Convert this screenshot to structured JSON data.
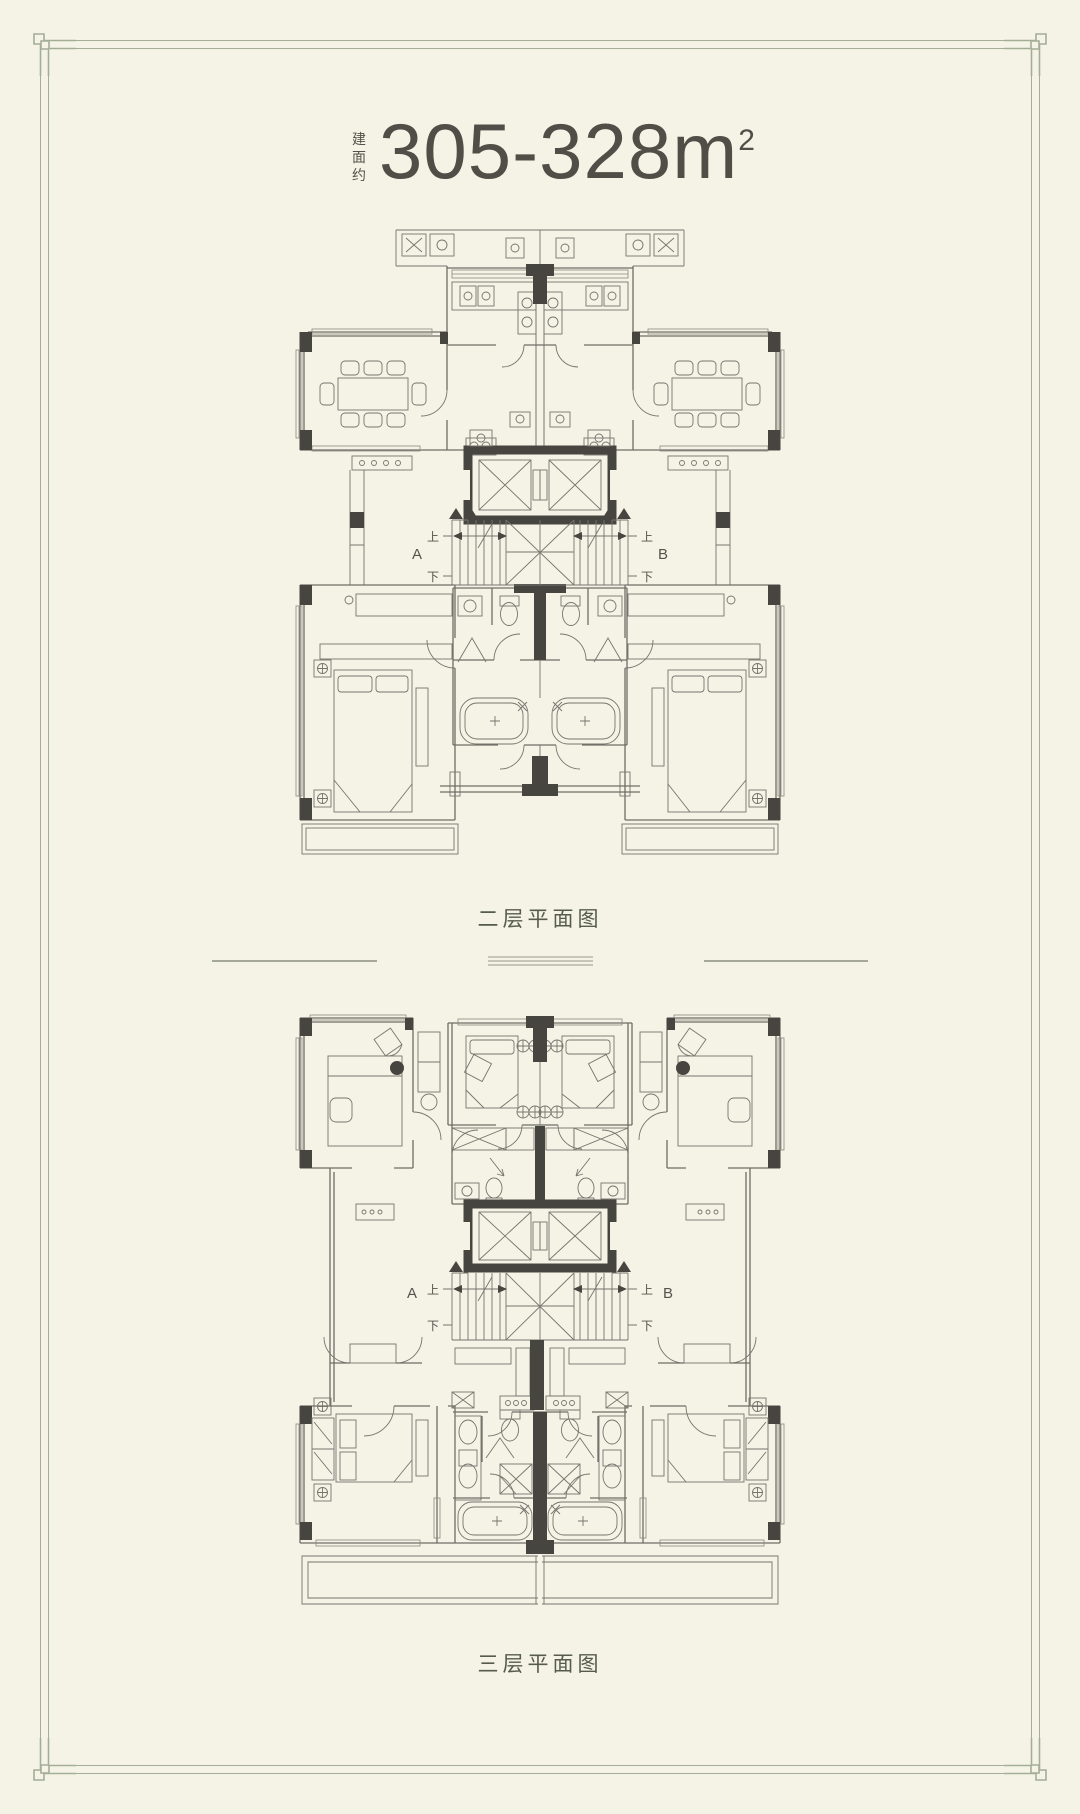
{
  "colors": {
    "background": "#f5f3e6",
    "frame": "#a4ad96",
    "line": "#6f6e66",
    "structural_wall": "#474540",
    "text": "#55524b"
  },
  "header": {
    "prefix": "建面约",
    "value": "305-328",
    "unit": "m",
    "exponent": "2"
  },
  "plans": [
    {
      "caption": "二层平面图",
      "unit_a": "A",
      "unit_b": "B",
      "up_label": "上",
      "down_label": "下"
    },
    {
      "caption": "三层平面图",
      "unit_a": "A",
      "unit_b": "B",
      "up_label": "上",
      "down_label": "下"
    }
  ]
}
